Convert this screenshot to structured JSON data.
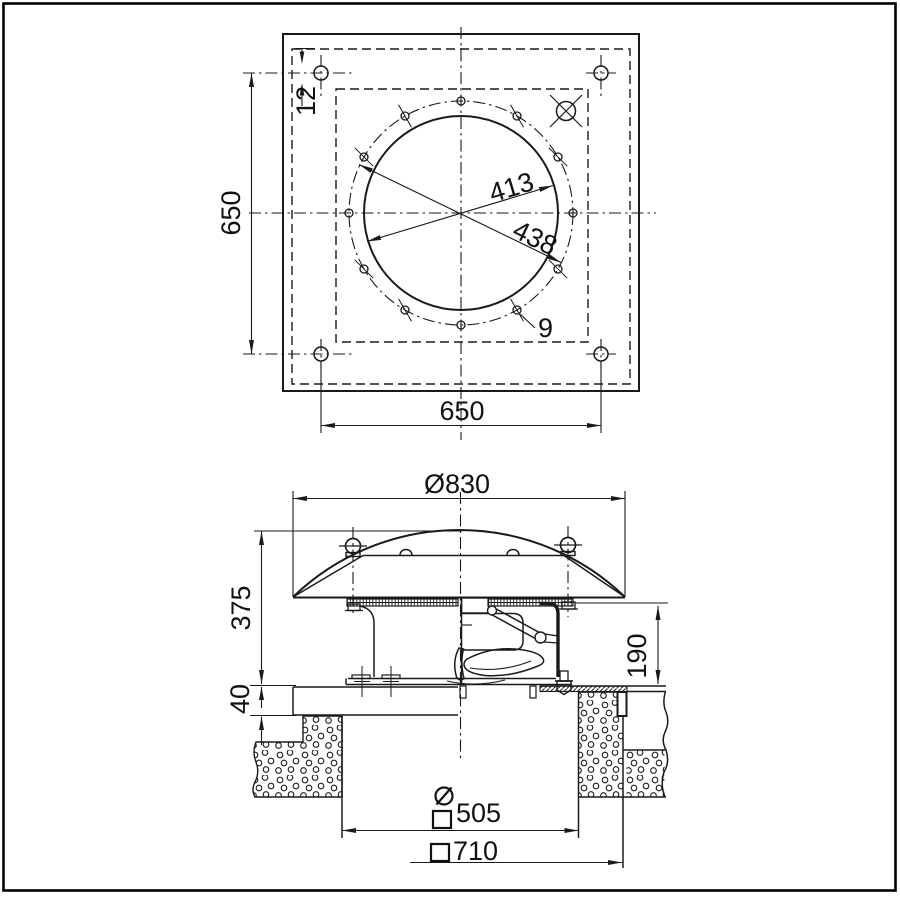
{
  "top_view": {
    "plate_height_label": "650",
    "plate_width_label": "650",
    "corner_hole_label": "12",
    "inner_circle_dia_label": "413",
    "bolt_circle_dia_label": "438",
    "bolt_hole_dia_label": "9"
  },
  "side_view": {
    "hood_dia_label": "Ø830",
    "total_height_label": "375",
    "casing_height_label": "190",
    "roof_offset_label": "40",
    "opening_dia_prefix": "Ø",
    "opening_size_label": "505",
    "base_size_label": "710"
  }
}
